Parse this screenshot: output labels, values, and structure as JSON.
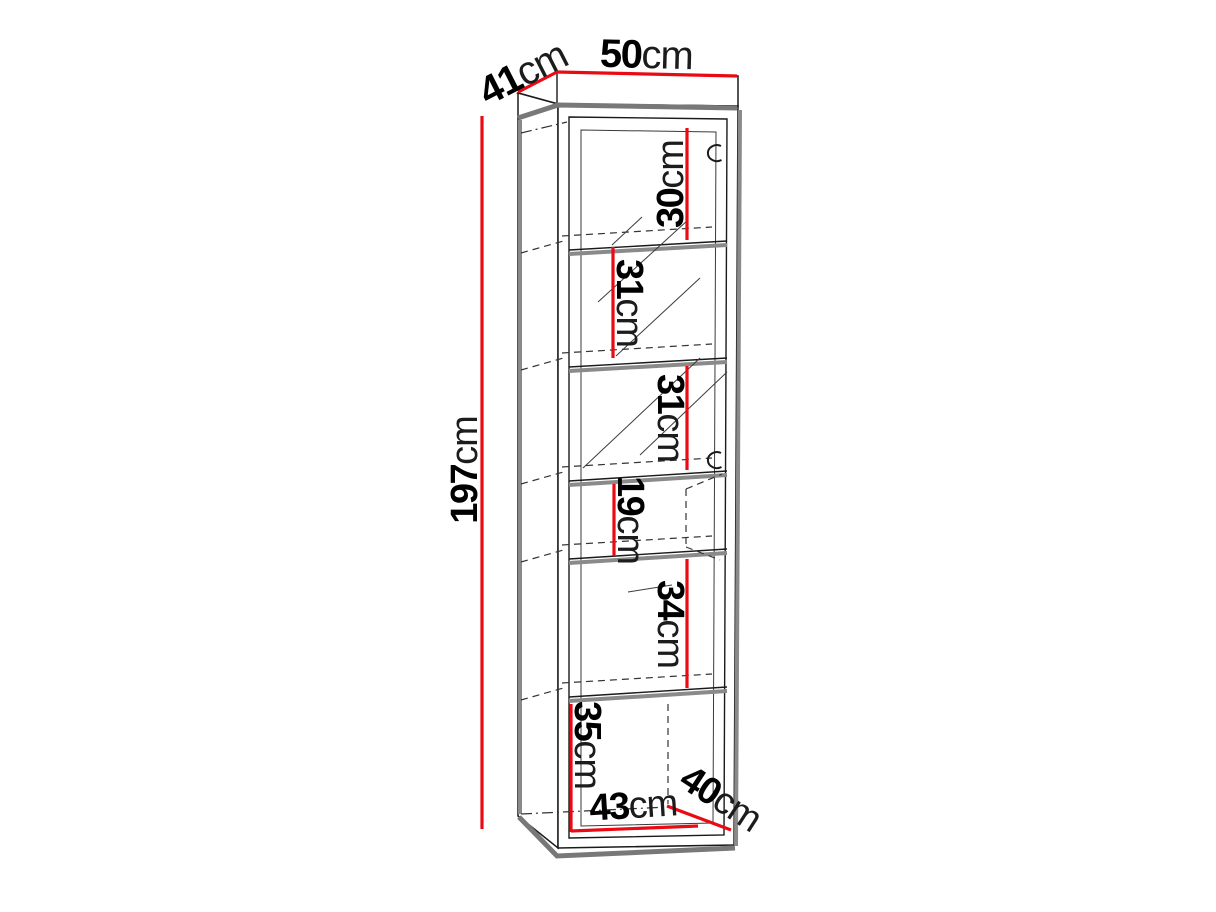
{
  "diagram": {
    "type": "furniture-dimension-drawing",
    "subject": "tall display cabinet with glass door and five shelves",
    "accent_color": "#ea0a14",
    "line_color": "#1a1a1a",
    "unit": "cm",
    "overall": {
      "width": {
        "value": "50",
        "unit": "cm"
      },
      "depth": {
        "value": "41",
        "unit": "cm"
      },
      "height": {
        "value": "197",
        "unit": "cm"
      }
    },
    "compartments": [
      {
        "name": "section-1",
        "value": "30",
        "unit": "cm"
      },
      {
        "name": "section-2",
        "value": "31",
        "unit": "cm"
      },
      {
        "name": "section-3",
        "value": "31",
        "unit": "cm"
      },
      {
        "name": "section-4",
        "value": "19",
        "unit": "cm"
      },
      {
        "name": "section-5",
        "value": "34",
        "unit": "cm"
      },
      {
        "name": "section-6",
        "value": "35",
        "unit": "cm"
      }
    ],
    "interior": {
      "width": {
        "value": "43",
        "unit": "cm"
      },
      "depth": {
        "value": "40",
        "unit": "cm"
      }
    }
  }
}
